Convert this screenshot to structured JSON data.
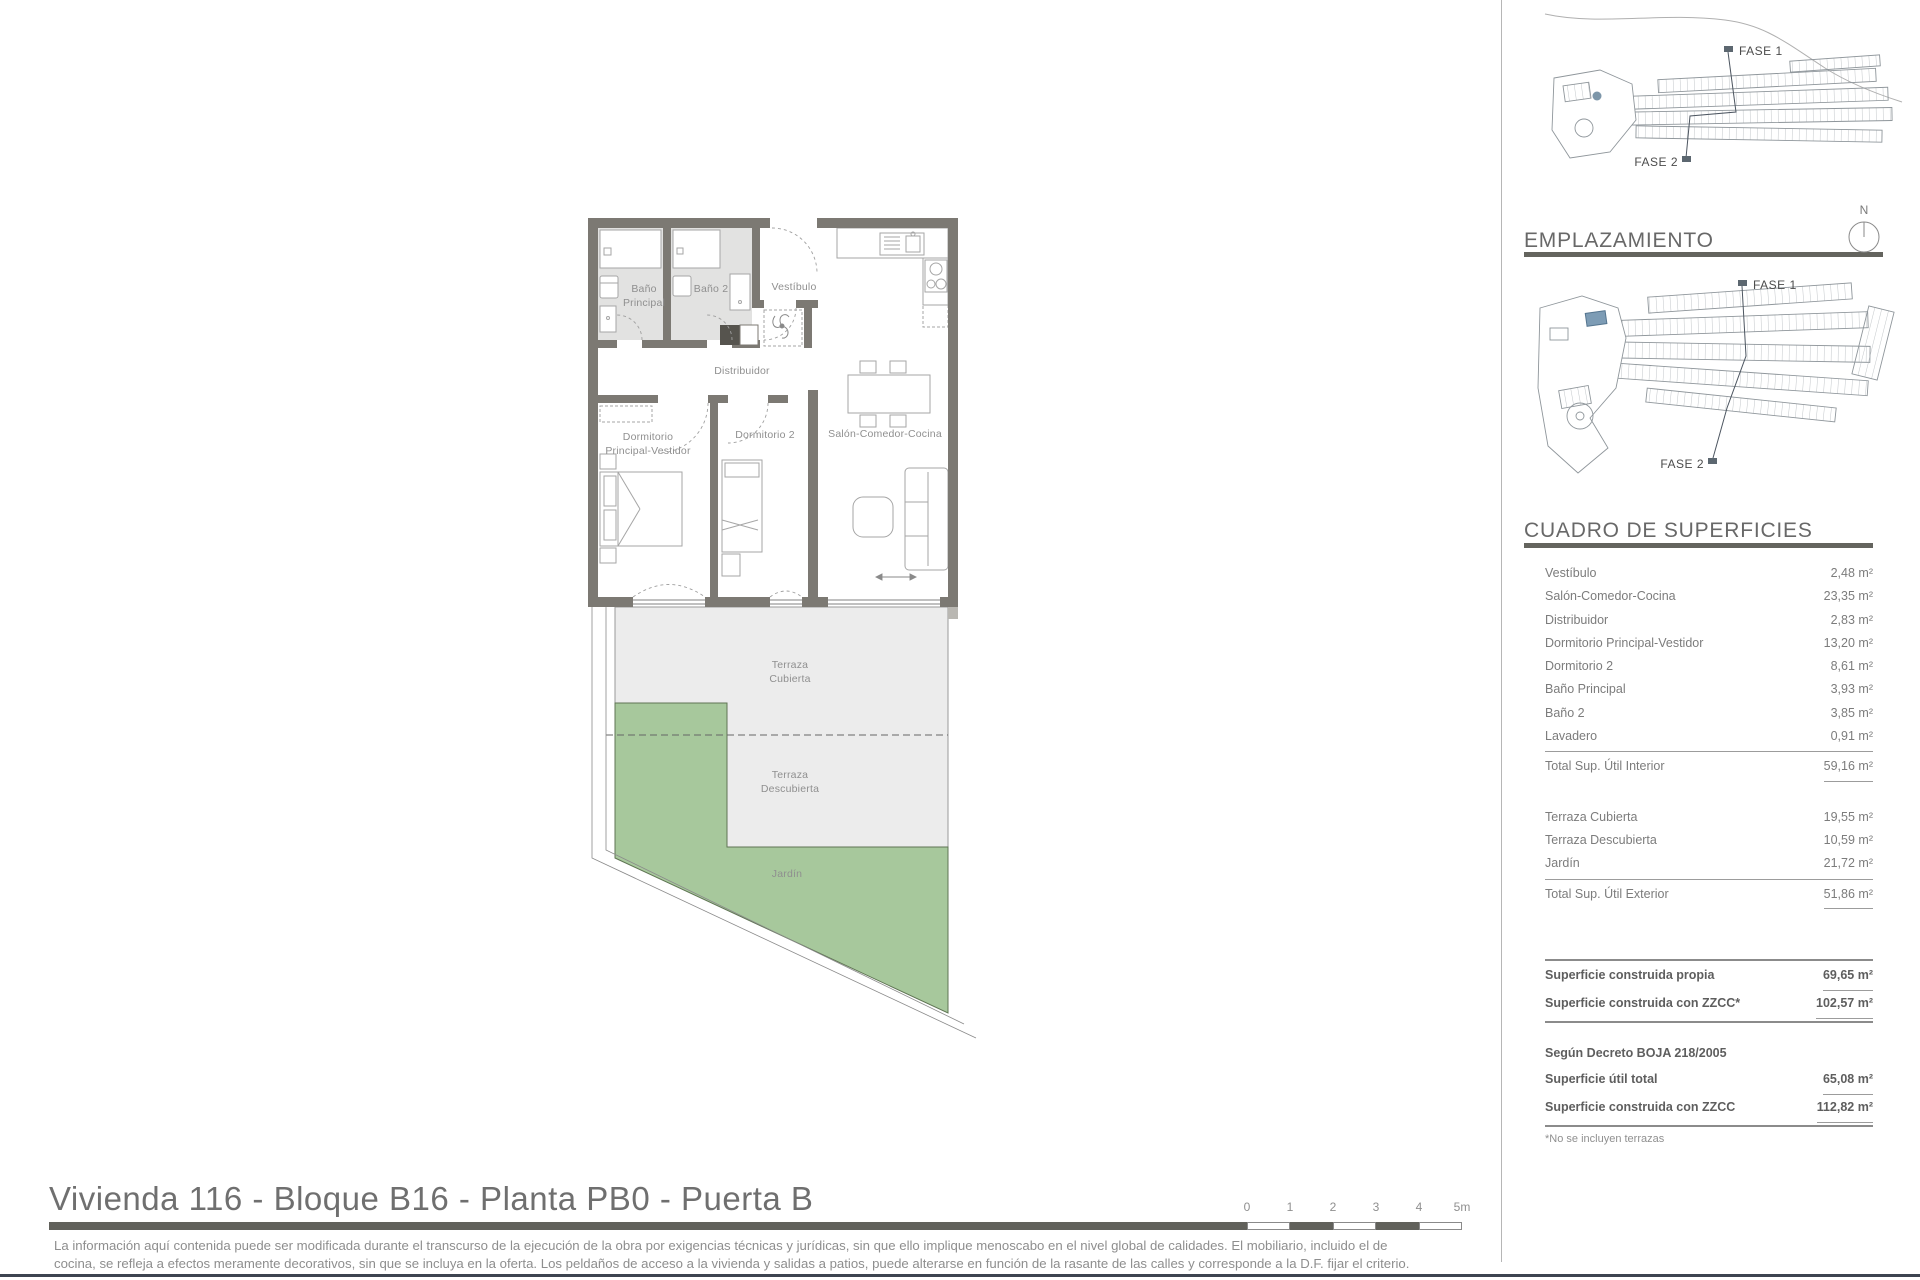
{
  "plan": {
    "labels": {
      "bano_principal": [
        "Baño",
        "Principal"
      ],
      "bano2": "Baño 2",
      "vestibulo": "Vestíbulo",
      "distribuidor": "Distribuidor",
      "dorm_principal": [
        "Dormitorio",
        "Principal-Vestidor"
      ],
      "dorm2": "Dormitorio 2",
      "salon": "Salón-Comedor-Cocina",
      "terraza_cubierta": [
        "Terraza",
        "Cubierta"
      ],
      "terraza_descubierta": [
        "Terraza",
        "Descubierta"
      ],
      "jardin": "Jardín"
    }
  },
  "sidebar": {
    "siteplan_top": {
      "fase1": "FASE 1",
      "fase2": "FASE 2"
    },
    "emplazamiento": {
      "title": "EMPLAZAMIENTO",
      "north": "N",
      "fase1": "FASE 1",
      "fase2": "FASE 2"
    },
    "superficies": {
      "title": "CUADRO DE SUPERFICIES",
      "interior_rows": [
        {
          "label": "Vestíbulo",
          "value": "2,48 m²"
        },
        {
          "label": "Salón-Comedor-Cocina",
          "value": "23,35 m²"
        },
        {
          "label": "Distribuidor",
          "value": "2,83 m²"
        },
        {
          "label": "Dormitorio Principal-Vestidor",
          "value": "13,20 m²"
        },
        {
          "label": "Dormitorio 2",
          "value": "8,61 m²"
        },
        {
          "label": "Baño Principal",
          "value": "3,93 m²"
        },
        {
          "label": "Baño 2",
          "value": "3,85 m²"
        },
        {
          "label": "Lavadero",
          "value": "0,91 m²"
        }
      ],
      "interior_total": {
        "label": "Total Sup. Útil Interior",
        "value": "59,16 m²"
      },
      "exterior_rows": [
        {
          "label": "Terraza Cubierta",
          "value": "19,55 m²"
        },
        {
          "label": "Terraza Descubierta",
          "value": "10,59 m²"
        },
        {
          "label": "Jardín",
          "value": "21,72 m²"
        }
      ],
      "exterior_total": {
        "label": "Total Sup. Útil Exterior",
        "value": "51,86 m²"
      },
      "construida_rows": [
        {
          "label": "Superficie construida propia",
          "value": "69,65 m²"
        },
        {
          "label": "Superficie construida con ZZCC*",
          "value": "102,57 m²"
        }
      ],
      "decreto_heading": "Según Decreto BOJA 218/2005",
      "decreto_rows": [
        {
          "label": "Superficie útil total",
          "value": "65,08 m²"
        },
        {
          "label": "Superficie construida con ZZCC",
          "value": "112,82 m²"
        }
      ],
      "footnote": "*No se incluyen terrazas"
    }
  },
  "footer": {
    "title": "Vivienda 116 - Bloque B16 - Planta PB0 - Puerta B",
    "disclaimer": [
      "La información aquí contenida puede ser modificada durante el transcurso de la ejecución de la obra por exigencias técnicas y jurídicas, sin que ello implique menoscabo en el nivel global de calidades. El mobiliario, incluido el de",
      "cocina, se refleja a efectos meramente decorativos, sin que se incluya en la oferta. Los peldaños de acceso a la vivienda y salidas a patios, puede alterarse en función de la rasante de las calles y corresponde a la D.F. fijar el criterio."
    ],
    "scale_labels": [
      "0",
      "1",
      "2",
      "3",
      "4",
      "5m"
    ]
  },
  "colors": {
    "wall": "#7c7973",
    "terrace": "#ececec",
    "garden": "#a7c89c",
    "highlight_blue": "#7d9cb5",
    "heading_gray": "#686868",
    "footer_rule": "#3d4450"
  }
}
